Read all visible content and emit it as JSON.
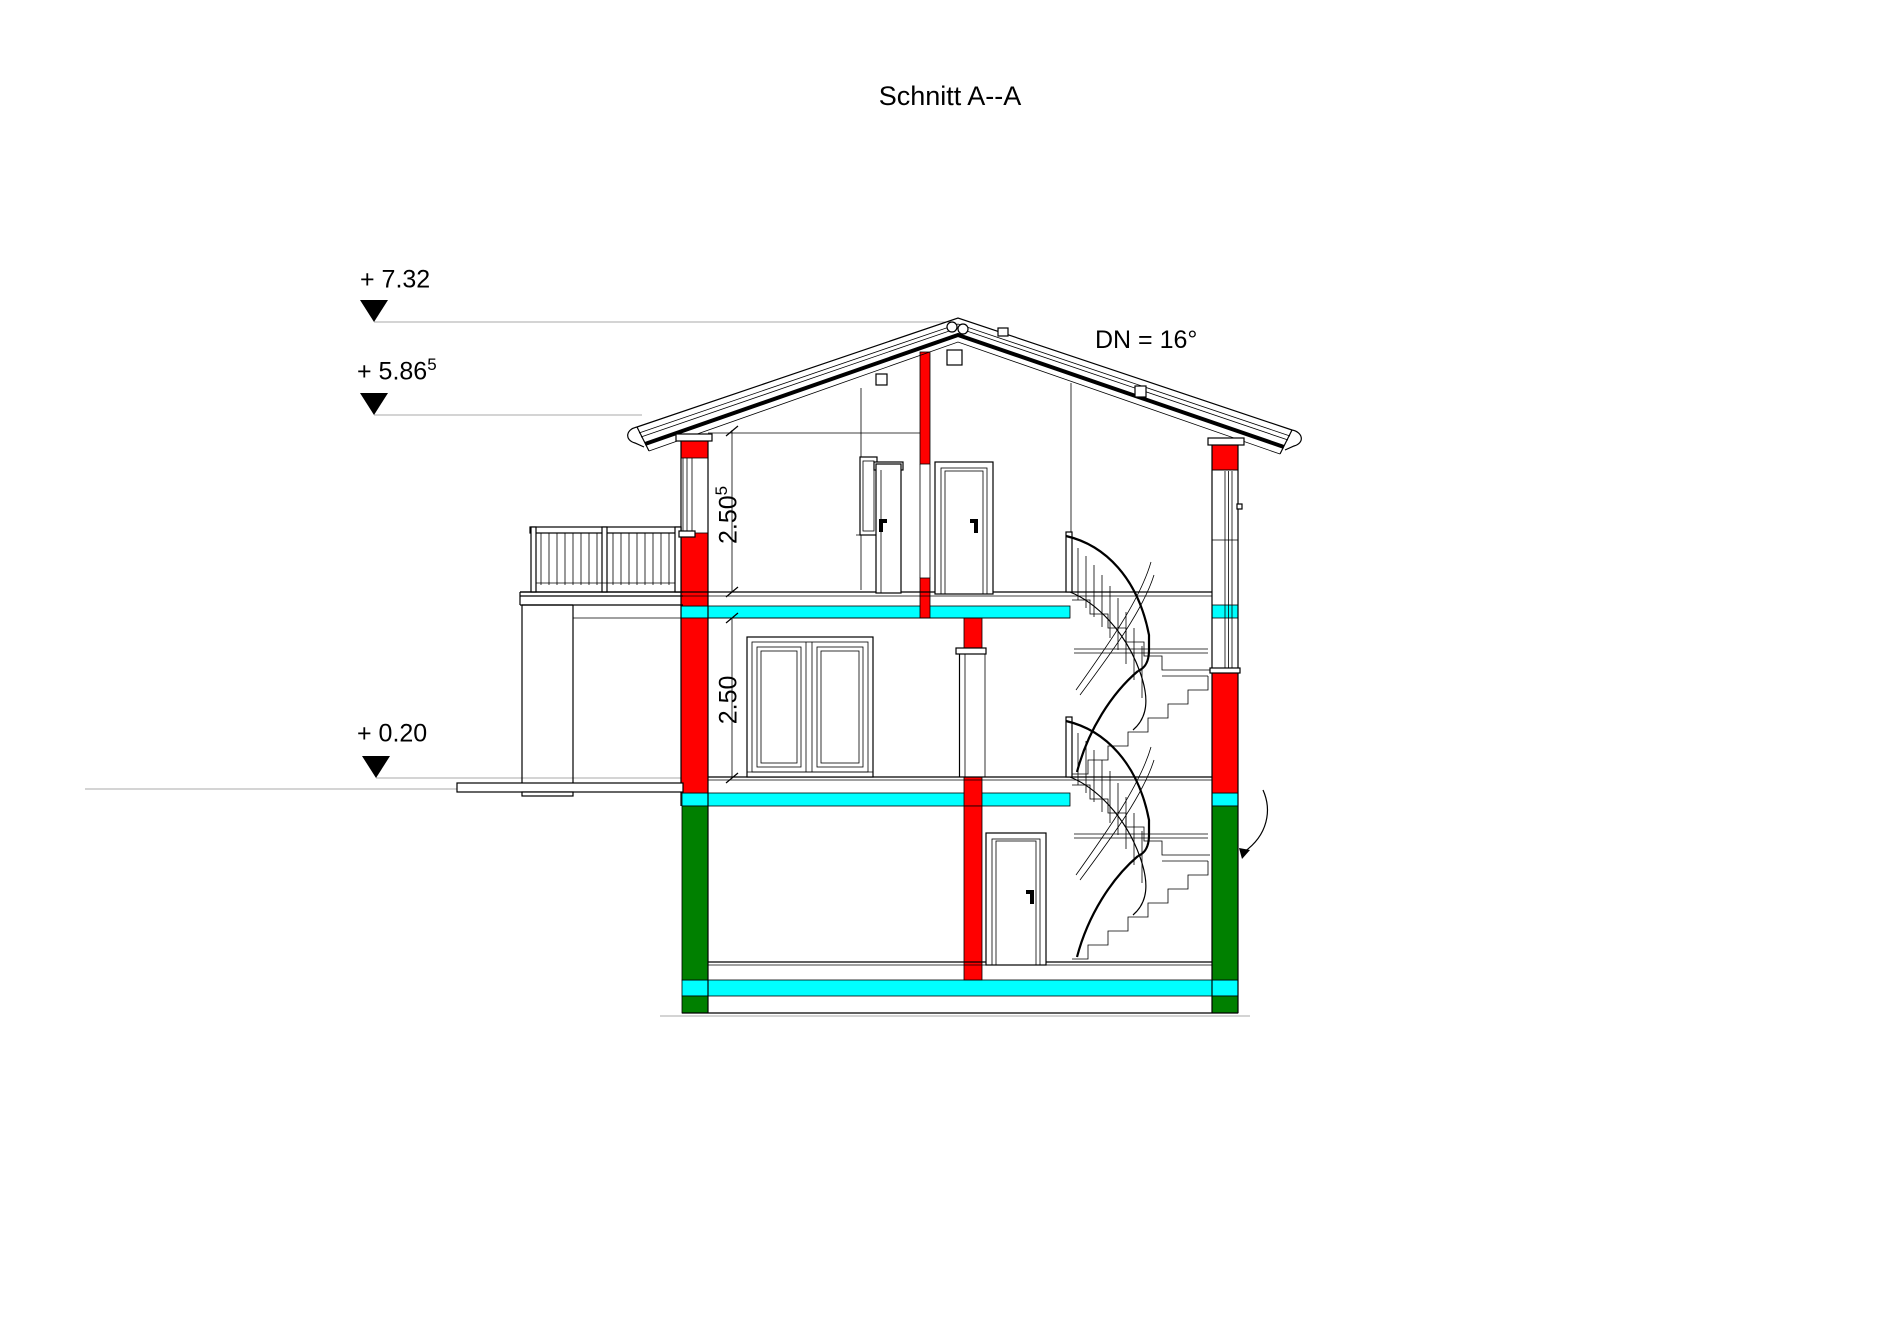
{
  "title": "Schnitt A--A",
  "annotations": {
    "roof_pitch_label": "DN = 16°",
    "elevation_markers": [
      {
        "label": "+ 7.32",
        "superscript": ""
      },
      {
        "label": "+ 5.86",
        "superscript": "5"
      },
      {
        "label": "+ 0.20",
        "superscript": ""
      }
    ],
    "dimension_labels": [
      {
        "label": "2.50",
        "superscript": "5"
      },
      {
        "label": "2.50",
        "superscript": ""
      }
    ]
  },
  "colors": {
    "cut_wall_red": "#ff0000",
    "cut_slab_cyan": "#00ffff",
    "cut_basement_green": "#008000",
    "line_black": "#000000",
    "datum_gray": "#a9a9a9",
    "background": "#ffffff"
  }
}
